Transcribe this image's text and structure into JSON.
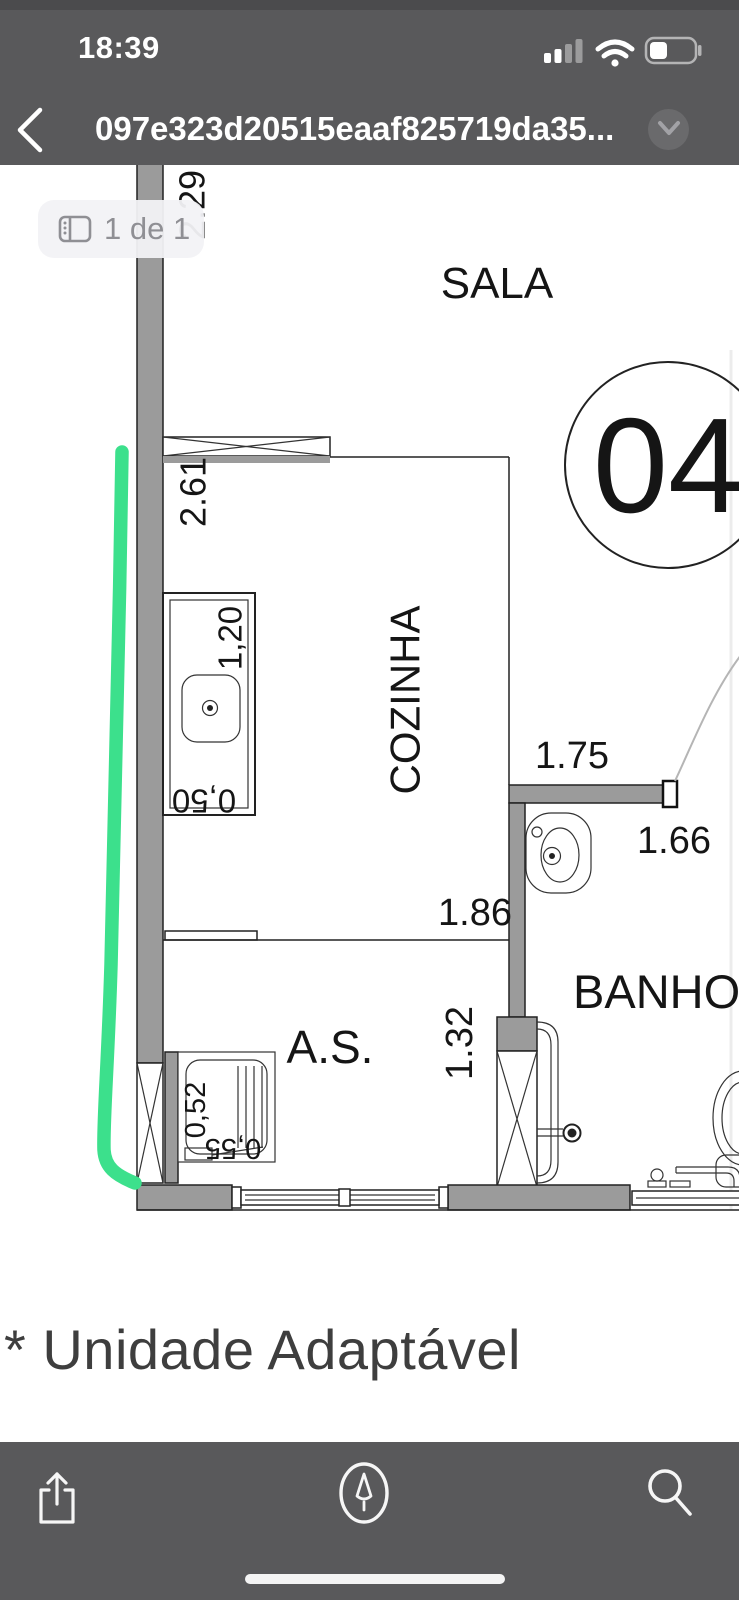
{
  "status_bar": {
    "time": "18:39"
  },
  "nav_bar": {
    "filename": "097e323d20515eaaf825719da35..."
  },
  "viewer": {
    "page_indicator": "1 de 1",
    "note": "* Unidade Adaptável"
  },
  "floor_plan": {
    "unit_number": "04",
    "rooms": {
      "sala": "SALA",
      "cozinha": "COZINHA",
      "servico": "A.S.",
      "banho": "BANHO"
    },
    "dims": {
      "sala_left": "2.29",
      "cozinha_left": "2.61",
      "counter_len": "1,20",
      "counter_dep": "0,50",
      "banho_top": "1.75",
      "banho_right": "1.66",
      "cozinha_bottom": "1.86",
      "as_right": "1.32",
      "tanque_w": "0,52",
      "tanque_d": "0,55"
    },
    "annotation_color": "#3ce08c"
  },
  "toolbar": {
    "icons": [
      "share",
      "markup",
      "search"
    ]
  },
  "colors": {
    "chrome": "#59595b",
    "wall": "#9b9b9b",
    "ink": "#151515",
    "note_text": "#3e3e3e"
  }
}
